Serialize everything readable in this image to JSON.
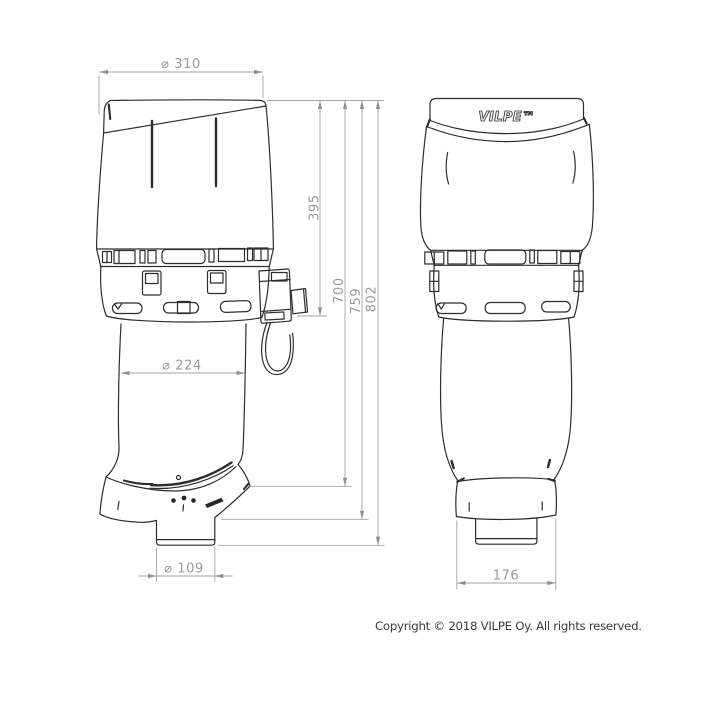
{
  "drawing": {
    "dims": {
      "d310": "⌀ 310",
      "h395": "395",
      "h700": "700",
      "h759": "759",
      "h802": "802",
      "d224": "⌀ 224",
      "d109": "⌀ 109",
      "d176": "176"
    },
    "logo": "VILPE™",
    "colors": {
      "line": "#2d2d2d",
      "dimension_line": "#a3a3a3",
      "dimension_text": "#9a9a9a",
      "outlet_bar_fill": "#9b9b9b",
      "background": "#ffffff"
    }
  },
  "footer": {
    "copyright": "Copyright © 2018 VILPE Oy. All rights reserved."
  }
}
